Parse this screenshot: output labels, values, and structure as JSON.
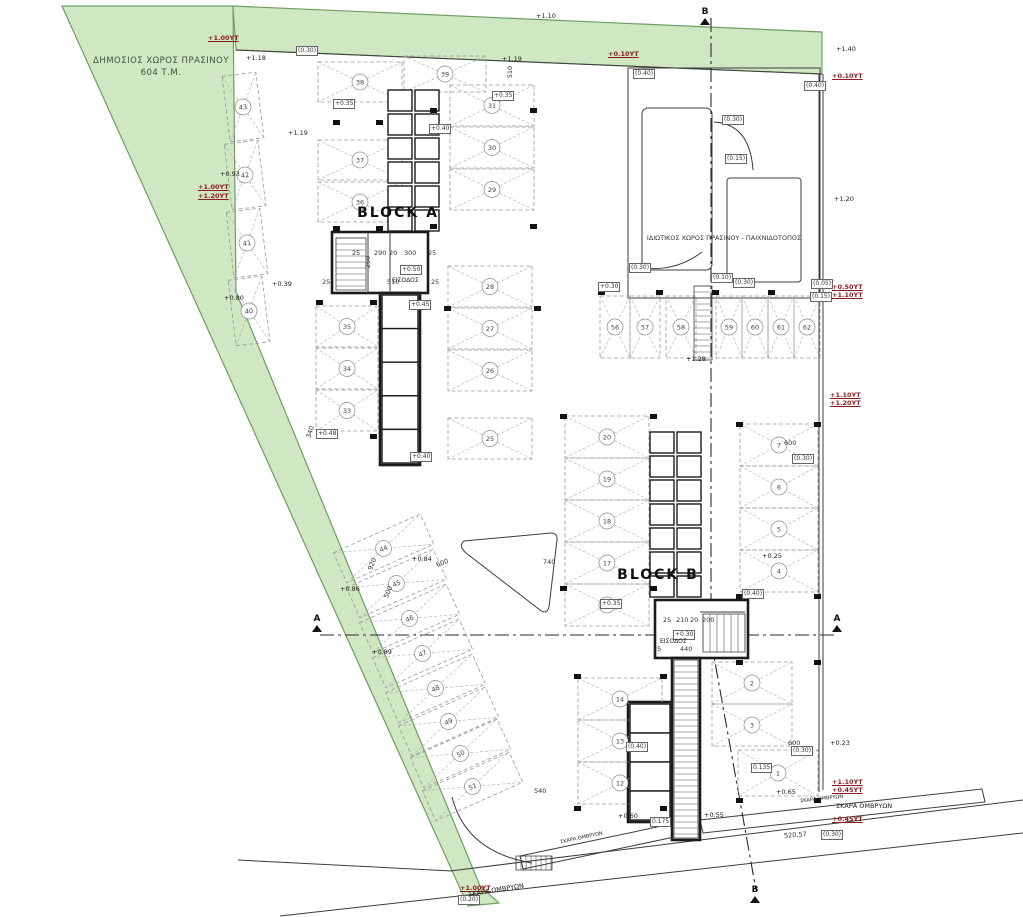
{
  "labels": {
    "public_green_line1": "ΔΗΜΟΣΙΟΣ ΧΩΡΟΣ ΠΡΑΣΙΝΟΥ",
    "public_green_line2": "604 Τ.Μ.",
    "private_green": "ΙΔΙΩΤΙΚΟΣ ΧΩΡΟΣ ΠΡΑΣΙΝΟΥ - ΠΑΙΧΝΙΔΟΤΟΠΟΣ",
    "block_a": "BLOCK A",
    "block_b": "BLOCK B",
    "entrance": "ΕΙΣΟΔΟΣ",
    "storm_grate": "ΣΚΑΡΑ ΟΜΒΡΥΩΝ"
  },
  "colors": {
    "green_fill": "#cfe7c3",
    "green_edge": "#6f9e63",
    "annotation_red": "#8e1b1b",
    "line": "#3c3c3c",
    "wall": "#1b1b1b"
  },
  "plan": {
    "parking": [
      {
        "n": 38,
        "x": 318,
        "y": 62,
        "w": 84,
        "h": 40
      },
      {
        "n": 37,
        "x": 318,
        "y": 140,
        "w": 84,
        "h": 40
      },
      {
        "n": 36,
        "x": 318,
        "y": 182,
        "w": 84,
        "h": 40
      },
      {
        "n": 35,
        "x": 316,
        "y": 306,
        "w": 62,
        "h": 41
      },
      {
        "n": 34,
        "x": 316,
        "y": 348,
        "w": 62,
        "h": 41
      },
      {
        "n": 33,
        "x": 316,
        "y": 390,
        "w": 62,
        "h": 41
      },
      {
        "n": 39,
        "x": 404,
        "y": 56,
        "w": 82,
        "h": 36
      },
      {
        "n": 31,
        "x": 450,
        "y": 85,
        "w": 84,
        "h": 41
      },
      {
        "n": 30,
        "x": 450,
        "y": 127,
        "w": 84,
        "h": 41
      },
      {
        "n": 29,
        "x": 450,
        "y": 169,
        "w": 84,
        "h": 41
      },
      {
        "n": 28,
        "x": 448,
        "y": 266,
        "w": 84,
        "h": 41
      },
      {
        "n": 27,
        "x": 448,
        "y": 308,
        "w": 84,
        "h": 41
      },
      {
        "n": 26,
        "x": 448,
        "y": 350,
        "w": 84,
        "h": 41
      },
      {
        "n": 25,
        "x": 448,
        "y": 418,
        "w": 84,
        "h": 41
      },
      {
        "n": 43,
        "x": 226,
        "y": 74,
        "w": 34,
        "h": 66,
        "r": -7
      },
      {
        "n": 42,
        "x": 228,
        "y": 142,
        "w": 34,
        "h": 66,
        "r": -7
      },
      {
        "n": 41,
        "x": 230,
        "y": 210,
        "w": 34,
        "h": 66,
        "r": -7
      },
      {
        "n": 40,
        "x": 232,
        "y": 278,
        "w": 34,
        "h": 66,
        "r": -7
      },
      {
        "n": 44,
        "x": 336,
        "y": 532,
        "w": 95,
        "h": 33,
        "r": -24
      },
      {
        "n": 45,
        "x": 349,
        "y": 567,
        "w": 95,
        "h": 33,
        "r": -24
      },
      {
        "n": 46,
        "x": 362,
        "y": 602,
        "w": 95,
        "h": 33,
        "r": -24
      },
      {
        "n": 47,
        "x": 375,
        "y": 637,
        "w": 95,
        "h": 33,
        "r": -24
      },
      {
        "n": 48,
        "x": 388,
        "y": 672,
        "w": 95,
        "h": 33,
        "r": -24
      },
      {
        "n": 49,
        "x": 401,
        "y": 705,
        "w": 95,
        "h": 33,
        "r": -24
      },
      {
        "n": 50,
        "x": 413,
        "y": 737,
        "w": 95,
        "h": 33,
        "r": -24
      },
      {
        "n": 51,
        "x": 425,
        "y": 770,
        "w": 95,
        "h": 33,
        "r": -24
      },
      {
        "n": 56,
        "x": 600,
        "y": 296,
        "w": 30,
        "h": 62
      },
      {
        "n": 57,
        "x": 630,
        "y": 296,
        "w": 30,
        "h": 62
      },
      {
        "n": 58,
        "x": 666,
        "y": 296,
        "w": 30,
        "h": 62
      },
      {
        "n": 59,
        "x": 716,
        "y": 296,
        "w": 26,
        "h": 62
      },
      {
        "n": 60,
        "x": 742,
        "y": 296,
        "w": 26,
        "h": 62
      },
      {
        "n": 61,
        "x": 768,
        "y": 296,
        "w": 26,
        "h": 62
      },
      {
        "n": 62,
        "x": 794,
        "y": 296,
        "w": 26,
        "h": 62
      },
      {
        "n": 20,
        "x": 565,
        "y": 416,
        "w": 84,
        "h": 42
      },
      {
        "n": 19,
        "x": 565,
        "y": 458,
        "w": 84,
        "h": 42
      },
      {
        "n": 18,
        "x": 565,
        "y": 500,
        "w": 84,
        "h": 42
      },
      {
        "n": 17,
        "x": 565,
        "y": 542,
        "w": 84,
        "h": 42
      },
      {
        "n": 16,
        "x": 565,
        "y": 584,
        "w": 84,
        "h": 42
      },
      {
        "n": 14,
        "x": 578,
        "y": 678,
        "w": 84,
        "h": 42
      },
      {
        "n": 13,
        "x": 578,
        "y": 720,
        "w": 84,
        "h": 42
      },
      {
        "n": 12,
        "x": 578,
        "y": 762,
        "w": 84,
        "h": 42
      },
      {
        "n": 7,
        "x": 740,
        "y": 424,
        "w": 78,
        "h": 42
      },
      {
        "n": 6,
        "x": 740,
        "y": 466,
        "w": 78,
        "h": 42
      },
      {
        "n": 5,
        "x": 740,
        "y": 508,
        "w": 78,
        "h": 42
      },
      {
        "n": 4,
        "x": 740,
        "y": 550,
        "w": 78,
        "h": 42
      },
      {
        "n": 2,
        "x": 712,
        "y": 662,
        "w": 80,
        "h": 42
      },
      {
        "n": 3,
        "x": 712,
        "y": 704,
        "w": 80,
        "h": 42
      },
      {
        "n": 1,
        "x": 738,
        "y": 750,
        "w": 80,
        "h": 46
      }
    ],
    "storage": {
      "a": {
        "x": 388,
        "y": 90,
        "rows": 6
      },
      "b": {
        "x": 650,
        "y": 432,
        "rows": 7
      }
    },
    "wings": [
      {
        "x": 382,
        "y": 295,
        "w": 36,
        "h": 168,
        "rows": 5
      },
      {
        "x": 630,
        "y": 704,
        "w": 40,
        "h": 116,
        "rows": 4
      }
    ],
    "ladders": [
      [
        336,
        238,
        30,
        52,
        6,
        "h"
      ],
      [
        703,
        614,
        42,
        38,
        7,
        "v"
      ],
      [
        674,
        660,
        24,
        178,
        6,
        "h"
      ],
      [
        694,
        286,
        18,
        74,
        6,
        "h"
      ],
      [
        516,
        856,
        36,
        14,
        5,
        "v"
      ]
    ],
    "columns": [
      [
        333,
        120
      ],
      [
        376,
        120
      ],
      [
        333,
        226
      ],
      [
        376,
        226
      ],
      [
        430,
        108
      ],
      [
        530,
        108
      ],
      [
        430,
        224
      ],
      [
        530,
        224
      ],
      [
        316,
        300
      ],
      [
        370,
        300
      ],
      [
        316,
        434
      ],
      [
        370,
        434
      ],
      [
        444,
        306
      ],
      [
        534,
        306
      ],
      [
        598,
        290
      ],
      [
        656,
        290
      ],
      [
        712,
        290
      ],
      [
        768,
        290
      ],
      [
        560,
        414
      ],
      [
        650,
        414
      ],
      [
        736,
        422
      ],
      [
        814,
        422
      ],
      [
        560,
        586
      ],
      [
        650,
        586
      ],
      [
        736,
        594
      ],
      [
        814,
        594
      ],
      [
        574,
        674
      ],
      [
        660,
        674
      ],
      [
        574,
        806
      ],
      [
        660,
        806
      ],
      [
        736,
        660
      ],
      [
        814,
        660
      ],
      [
        736,
        798
      ],
      [
        814,
        798
      ]
    ],
    "black_levels": [
      {
        "t": "+1.18",
        "x": 246,
        "y": 54
      },
      {
        "t": "+1.19",
        "x": 288,
        "y": 129
      },
      {
        "t": "+1.19",
        "x": 502,
        "y": 55
      },
      {
        "t": "+1.10",
        "x": 536,
        "y": 12
      },
      {
        "t": "+0.93",
        "x": 220,
        "y": 170
      },
      {
        "t": "+0.80",
        "x": 224,
        "y": 294
      },
      {
        "t": "+0.39",
        "x": 272,
        "y": 280
      },
      {
        "t": "+0.84",
        "x": 412,
        "y": 555
      },
      {
        "t": "+0.86",
        "x": 340,
        "y": 585
      },
      {
        "t": "+0.89",
        "x": 372,
        "y": 648
      },
      {
        "t": "+1.28",
        "x": 686,
        "y": 355
      },
      {
        "t": "+1.20",
        "x": 834,
        "y": 195
      },
      {
        "t": "+1.40",
        "x": 836,
        "y": 45
      },
      {
        "t": "+0.25",
        "x": 762,
        "y": 552
      },
      {
        "t": "+0.23",
        "x": 830,
        "y": 739
      },
      {
        "t": "+0.65",
        "x": 776,
        "y": 788
      },
      {
        "t": "+0.55",
        "x": 704,
        "y": 811
      },
      {
        "t": "+0.60",
        "x": 618,
        "y": 812
      }
    ],
    "red_levels": [
      {
        "t": "+1.00ΥΤ",
        "x": 208,
        "y": 34
      },
      {
        "t": "+1.00ΥΤ",
        "x": 198,
        "y": 183
      },
      {
        "t": "+1.20ΥΤ",
        "x": 198,
        "y": 192
      },
      {
        "t": "+0.10ΥΤ",
        "x": 832,
        "y": 72
      },
      {
        "t": "+0.50ΥΤ",
        "x": 832,
        "y": 283
      },
      {
        "t": "+1.10ΥΤ",
        "x": 832,
        "y": 291
      },
      {
        "t": "+1.10ΥΤ",
        "x": 830,
        "y": 391
      },
      {
        "t": "+1.20ΥΤ",
        "x": 830,
        "y": 399
      },
      {
        "t": "+1.10ΥΤ",
        "x": 832,
        "y": 778
      },
      {
        "t": "+0.45ΥΤ",
        "x": 832,
        "y": 786
      },
      {
        "t": "+0.45ΥΤ",
        "x": 832,
        "y": 815
      },
      {
        "t": "+1.00ΥΤ",
        "x": 460,
        "y": 884
      },
      {
        "t": "+0.10ΥΤ",
        "x": 608,
        "y": 50
      }
    ],
    "boxes": [
      {
        "t": "(0.30)",
        "x": 296,
        "y": 46
      },
      {
        "t": "(0.40)",
        "x": 633,
        "y": 69
      },
      {
        "t": "(0.40)",
        "x": 804,
        "y": 81
      },
      {
        "t": "(0.30)",
        "x": 722,
        "y": 115
      },
      {
        "t": "(0.15)",
        "x": 725,
        "y": 154
      },
      {
        "t": "(0.30)",
        "x": 629,
        "y": 263
      },
      {
        "t": "(0.10)",
        "x": 711,
        "y": 273
      },
      {
        "t": "(0.30)",
        "x": 733,
        "y": 278
      },
      {
        "t": "(0.05)",
        "x": 811,
        "y": 279
      },
      {
        "t": "(0.15)",
        "x": 810,
        "y": 292
      },
      {
        "t": "(0.30)",
        "x": 792,
        "y": 454
      },
      {
        "t": "(0.30)",
        "x": 791,
        "y": 746
      },
      {
        "t": "(0.30)",
        "x": 821,
        "y": 830
      },
      {
        "t": "(0.20)",
        "x": 458,
        "y": 895
      },
      {
        "t": "+0.35",
        "x": 333,
        "y": 99
      },
      {
        "t": "+0.40",
        "x": 429,
        "y": 124
      },
      {
        "t": "+0.35",
        "x": 492,
        "y": 91
      },
      {
        "t": "+0.50",
        "x": 400,
        "y": 265
      },
      {
        "t": "+0.45",
        "x": 409,
        "y": 300
      },
      {
        "t": "+0.30",
        "x": 598,
        "y": 282
      },
      {
        "t": "+0.30",
        "x": 673,
        "y": 630
      },
      {
        "t": "(0.40)",
        "x": 742,
        "y": 589
      },
      {
        "t": "(0.40)",
        "x": 626,
        "y": 742
      },
      {
        "t": "+0.35",
        "x": 600,
        "y": 599
      },
      {
        "t": "0.175",
        "x": 650,
        "y": 817
      },
      {
        "t": "0.135",
        "x": 751,
        "y": 763
      },
      {
        "t": "+0.48",
        "x": 316,
        "y": 429
      },
      {
        "t": "+0.40",
        "x": 410,
        "y": 452
      }
    ],
    "dims": [
      {
        "t": "25",
        "x": 352,
        "y": 249
      },
      {
        "t": "290",
        "x": 374,
        "y": 249
      },
      {
        "t": "20",
        "x": 389,
        "y": 249
      },
      {
        "t": "300",
        "x": 404,
        "y": 249
      },
      {
        "t": "25",
        "x": 428,
        "y": 249
      },
      {
        "t": "510",
        "x": 387,
        "y": 278
      },
      {
        "t": "250",
        "x": 362,
        "y": 258,
        "r": -90
      },
      {
        "t": "25",
        "x": 322,
        "y": 278
      },
      {
        "t": "25",
        "x": 431,
        "y": 278
      },
      {
        "t": "25",
        "x": 663,
        "y": 616
      },
      {
        "t": "210",
        "x": 676,
        "y": 616
      },
      {
        "t": "20",
        "x": 690,
        "y": 616
      },
      {
        "t": "200",
        "x": 702,
        "y": 616
      },
      {
        "t": "440",
        "x": 680,
        "y": 645
      },
      {
        "t": "25",
        "x": 653,
        "y": 645
      },
      {
        "t": "600",
        "x": 784,
        "y": 439
      },
      {
        "t": "600",
        "x": 788,
        "y": 739
      },
      {
        "t": "740",
        "x": 543,
        "y": 558
      },
      {
        "t": "540",
        "x": 534,
        "y": 787
      },
      {
        "t": "340",
        "x": 304,
        "y": 428,
        "r": -72
      },
      {
        "t": "920",
        "x": 366,
        "y": 560,
        "r": -68
      },
      {
        "t": "500",
        "x": 382,
        "y": 588,
        "r": -68
      },
      {
        "t": "600",
        "x": 436,
        "y": 559,
        "r": -20
      },
      {
        "t": "510",
        "x": 504,
        "y": 68,
        "r": -90
      },
      {
        "t": "520.57",
        "x": 784,
        "y": 831,
        "r": -4
      }
    ],
    "sections": [
      {
        "t": "Β",
        "x": 698,
        "y": 8
      },
      {
        "t": "Α",
        "x": 310,
        "y": 615
      },
      {
        "t": "Α",
        "x": 830,
        "y": 615
      },
      {
        "t": "Β",
        "x": 748,
        "y": 886
      }
    ]
  }
}
